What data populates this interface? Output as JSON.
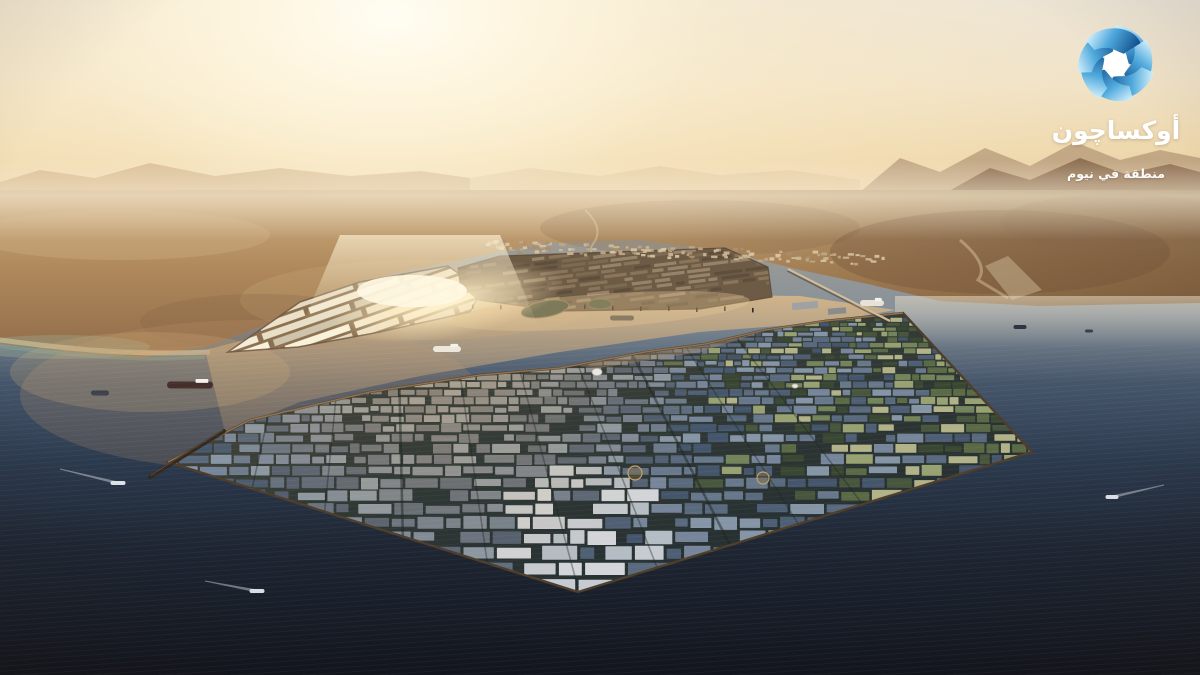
{
  "branding": {
    "wordmark_ar": "أوكساچون",
    "tagline_ar": "منطقة في نيوم",
    "text_color": "#ffffff",
    "logo_palette": {
      "light": "#d6f2fd",
      "mid": "#4fa9dc",
      "dark": "#14538f"
    }
  },
  "scene": {
    "alt_text": "Sunrise aerial render of an octagonal industrial port city extending into a dark sea, desert mountains on the hazy horizon",
    "palette": {
      "sky_top": "#e8e2d8",
      "sky_warm": "#ecd9b4",
      "sun_core": "#fffdf4",
      "desert_light": "#c9a97b",
      "desert_mid": "#ac855a",
      "desert_dark": "#7c5a3e",
      "sea_far": "#a29d93",
      "sea_mid": "#46566a",
      "sea_deep": "#1f2734",
      "sea_bottom": "#12151d",
      "harbor_glint": "#ffeec2",
      "berm": "#4e3d2b",
      "berm_lit": "#a07f57"
    },
    "city": {
      "roof_blue": [
        "#5a6a7e",
        "#4e5e74",
        "#68788c",
        "#76859a",
        "#45566c",
        "#8595a6"
      ],
      "roof_light": [
        "#c6cbd1",
        "#d2d5d9",
        "#b4bcc4"
      ],
      "roof_green": [
        "#47563c",
        "#3a4832",
        "#5a6a45",
        "#74845a",
        "#97a171",
        "#b2b289"
      ],
      "warm": "#c8a97c",
      "street": "#1d2622",
      "light_zone": {
        "x": 575,
        "y": 562,
        "r": 95
      },
      "sun_zone": {
        "x": 440,
        "y": 330,
        "r": 270
      }
    },
    "port": {
      "warehouse": [
        "#f4ecd8",
        "#e9dfc8",
        "#dcd1ba",
        "#cfc3ab"
      ],
      "container": [
        "#7d6a52",
        "#6d5b46",
        "#8a755b",
        "#5e4e3d",
        "#97826a"
      ],
      "suburb": [
        "#cdb996",
        "#bfa987",
        "#d8c6a4",
        "#a89070"
      ]
    },
    "landmarks": [
      {
        "x": 597,
        "y": 372,
        "r": 5,
        "kind": "stadium"
      },
      {
        "x": 795,
        "y": 386,
        "r": 3,
        "kind": "stadium"
      },
      {
        "x": 635,
        "y": 473,
        "r": 7,
        "kind": "plaza"
      },
      {
        "x": 763,
        "y": 478,
        "r": 6,
        "kind": "plaza"
      }
    ],
    "ships": [
      {
        "x": 190,
        "y": 385,
        "len": 46,
        "h": 7,
        "color": "#452f2a",
        "super": true
      },
      {
        "x": 100,
        "y": 393,
        "len": 18,
        "h": 5,
        "color": "#3c414c"
      },
      {
        "x": 118,
        "y": 483,
        "len": 15,
        "h": 4,
        "color": "#dde2e6",
        "wake": {
          "dx": -58,
          "dy": -14
        }
      },
      {
        "x": 257,
        "y": 591,
        "len": 15,
        "h": 4,
        "color": "#d9dee2",
        "wake": {
          "dx": -52,
          "dy": -10
        }
      },
      {
        "x": 1112,
        "y": 497,
        "len": 13,
        "h": 4,
        "color": "#d9dee2",
        "wake": {
          "dx": 52,
          "dy": -12
        }
      },
      {
        "x": 1020,
        "y": 327,
        "len": 13,
        "h": 4,
        "color": "#2e3540"
      },
      {
        "x": 1089,
        "y": 331,
        "len": 8,
        "h": 3,
        "color": "#3a414d"
      },
      {
        "x": 447,
        "y": 349,
        "len": 28,
        "h": 6,
        "color": "#ece7da",
        "super": true
      },
      {
        "x": 622,
        "y": 318,
        "len": 24,
        "h": 5,
        "color": "#57524b"
      },
      {
        "x": 872,
        "y": 303,
        "len": 24,
        "h": 6,
        "color": "#e6e2d8",
        "super": true
      }
    ]
  }
}
